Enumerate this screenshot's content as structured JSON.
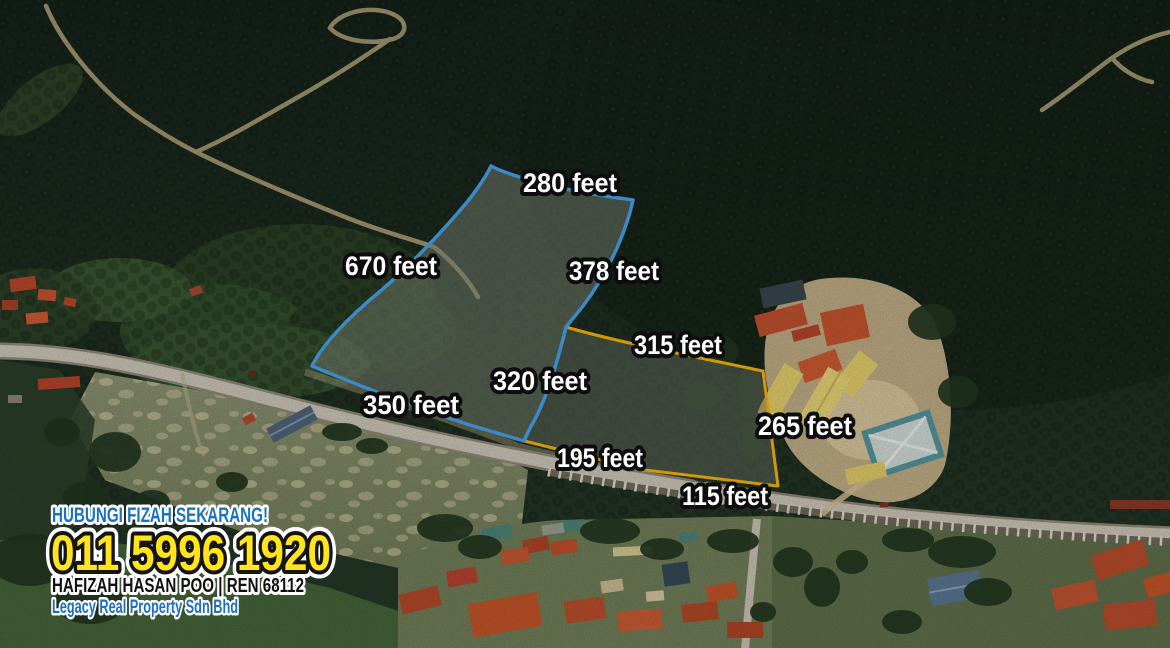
{
  "flyer": {
    "contact": {
      "headline": "HUBUNGI FIZAH SEKARANG!",
      "phone": "011 5996 1920",
      "agent": "HAFIZAH HASAN POO | REN 68112",
      "agency": "Legacy Real Property Sdn Bhd"
    }
  },
  "parcels": {
    "blue": {
      "boundary_color": "#48a2eb",
      "side_labels": [
        "280 feet",
        "670 feet",
        "378 feet",
        "320 feet",
        "350 feet"
      ]
    },
    "yellow": {
      "boundary_color": "#f5b40a",
      "side_labels": [
        "315 feet",
        "265 feet",
        "115 feet",
        "195 feet"
      ]
    }
  },
  "colors": {
    "dimension_label_fill": "#ffffff",
    "dimension_label_outline": "#0d0d0d",
    "contact_headline_blue": "#1873c2",
    "contact_phone_yellow": "#ffe51a",
    "contact_agent_black": "#101010",
    "contact_agency_blue": "#1b6fc5"
  }
}
